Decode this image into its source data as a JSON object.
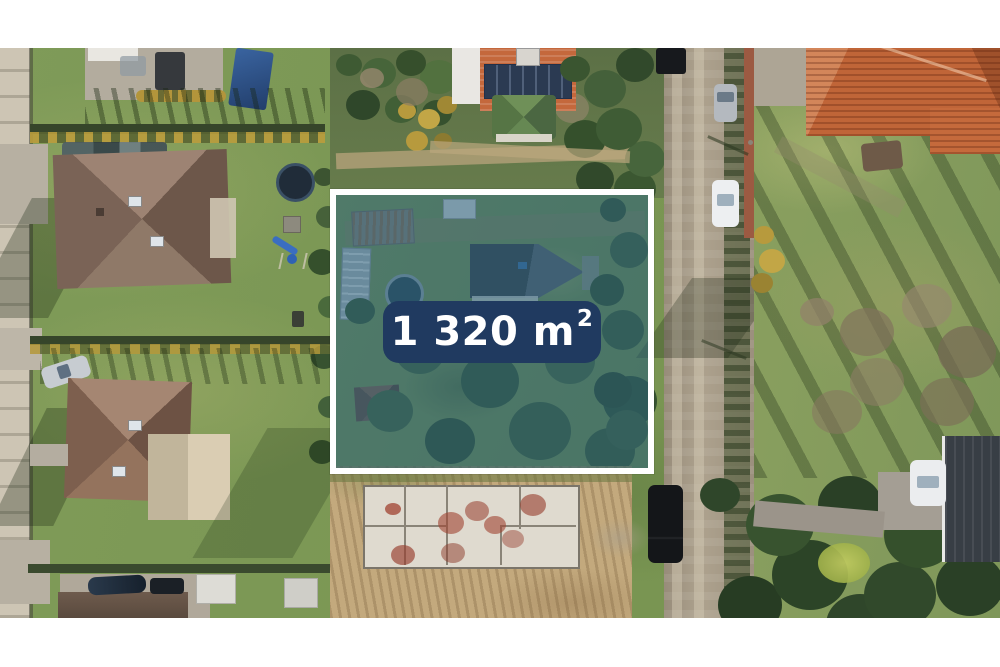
{
  "image_type": "aerial-drone-photo",
  "letterbox": {
    "color": "#ffffff"
  },
  "plot_overlay": {
    "area_text": "1 320 m",
    "area_exponent": "2",
    "area_full_label": "1 320 m²",
    "label_background_color": "#203a60",
    "label_text_color": "#ffffff",
    "boundary_border_color": "#ffffff",
    "tint_color": "rgba(40, 96, 124, 0.52)"
  }
}
